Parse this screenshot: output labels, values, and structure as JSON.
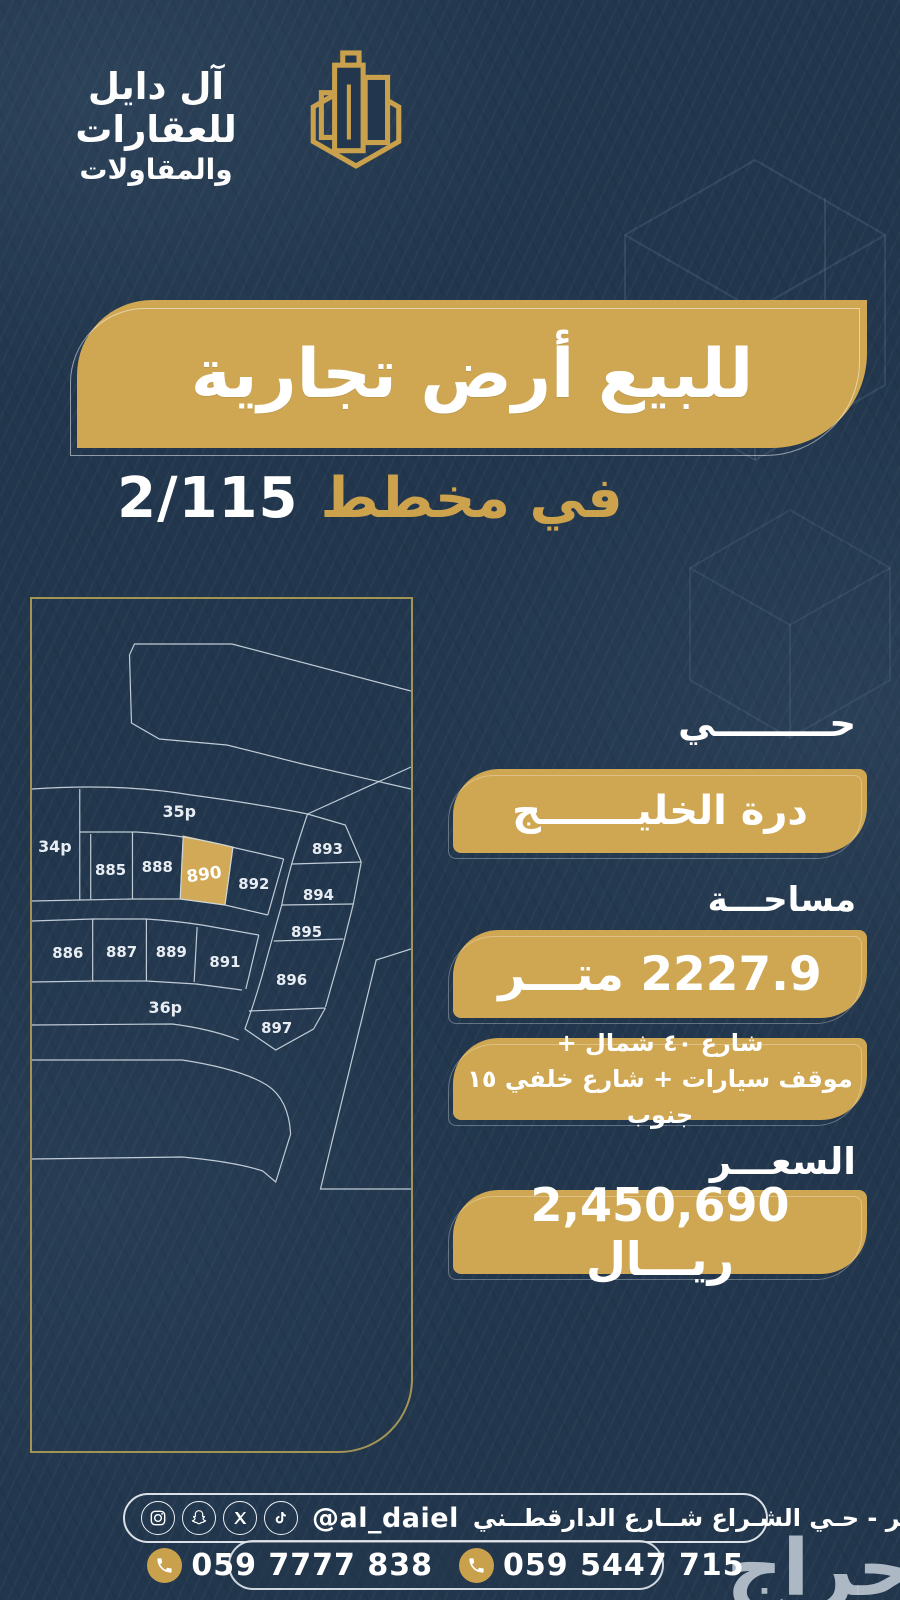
{
  "brand": {
    "line1": "آل دايل للعقارات",
    "line2": "والمقاولات"
  },
  "hero": {
    "title": "للبيع أرض تجارية",
    "subtitle_label": "في مخطط",
    "subtitle_number": "2/115"
  },
  "map": {
    "highlighted_plot": "890",
    "labels": {
      "s35": "35p",
      "s34": "34p",
      "s36": "36p",
      "p885": "885",
      "p886": "886",
      "p887": "887",
      "p888": "888",
      "p889": "889",
      "p890": "890",
      "p891": "891",
      "p892": "892",
      "p893": "893",
      "p894": "894",
      "p895": "895",
      "p896": "896",
      "p897": "897"
    }
  },
  "details": {
    "district_label": "حـــــــــي",
    "district_value": "درة الخليـــــــج",
    "area_label": "مساحـــة",
    "area_value": "2227.9 متـــر",
    "streets_line1": "شارع ٤٠ شمال +",
    "streets_line2": "موقف سيارات + شارع خلفي ١٥ جنوب",
    "price_label": "السعـــر",
    "price_value": "2,450,690 ريـــال"
  },
  "footer": {
    "address": "الخـبر - حـي الشـراع شــارع الدارقطــني",
    "handle": "@al_daiel",
    "phone_1": "059 7777 838",
    "phone_2": "059 5447 715",
    "watermark": "حراج"
  },
  "colors": {
    "background_navy": "#22374d",
    "accent_gold": "#cfa752",
    "frame_gold": "#a39455",
    "map_line": "#cdd8e2",
    "text_white": "#ffffff",
    "watermark_gray": "#b9c3ce"
  }
}
